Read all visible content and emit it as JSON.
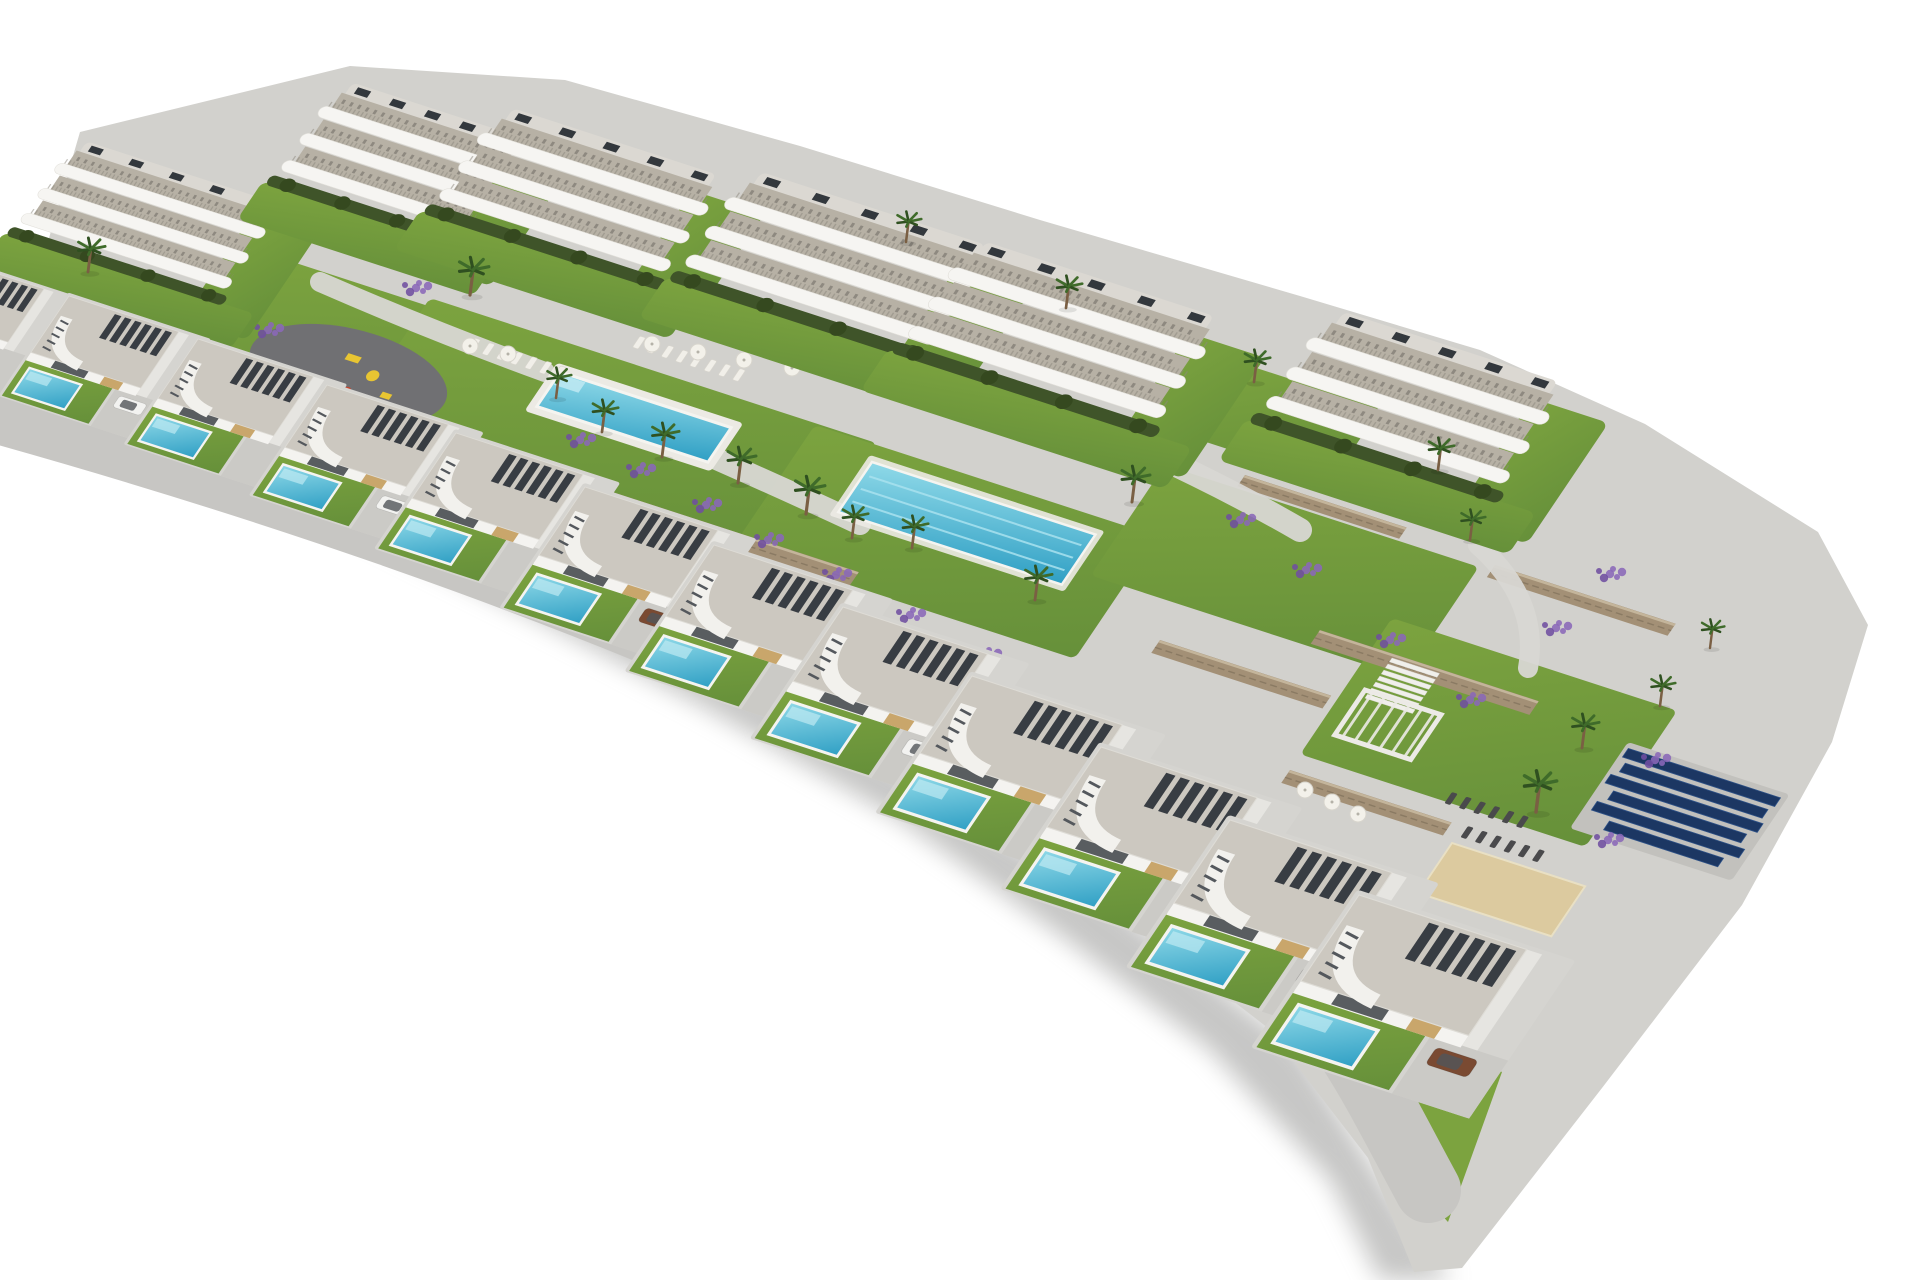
{
  "meta": {
    "type": "aerial-architectural-render",
    "description": "Aerial 3D render of a hillside residential development: six white curved-balcony apartment blocks along the top; landscaped gardens with a rectangular communal pool surrounded by sun loungers and parasols, a long lap pool, and a playground; stone retaining walls, palm trees and lavender beds; a stepped diagonal row of twelve modern villas, each with a gravel roof, dark pergola slats, curved stair canopy, lawn, private plunge pool and driveway; a solar-panel array, white pergola, dark loungers and a sand petanque court at the lower right; white background with soft drop shadow."
  },
  "summary": {
    "apartment_buildings": 6,
    "villas": 12,
    "private_pools": 12,
    "communal_pools": 2,
    "playgrounds": 1,
    "solar_panel_rows": 6,
    "visible_cars": 6,
    "palm_trees": 20
  },
  "colors": {
    "page_bg": "#ffffff",
    "ground": "#d2d1cd",
    "road": "#c7c6c3",
    "walkway": "#cfcecb",
    "path": "#d8d7d3",
    "concrete": "#d5d4d0",
    "driveway": "#cbcac6",
    "lawn": "#7ca33f",
    "lawn_dark": "#66903a",
    "hedge": "#3f5429",
    "hedge_dark": "#35491f",
    "pool_light": "#8fd9e8",
    "pool_deep": "#2f9fc4",
    "pool_step": "#bfe9f2",
    "pool_edge": "#f5f4f0",
    "lane_line": "#a9e2ef",
    "roof_gravel": "#ccc8c0",
    "roof_edge": "#dedcd6",
    "slat_dark": "#383d43",
    "wall_white": "#f4f3f0",
    "side_wall": "#e6e5e1",
    "wood": "#c9a66b",
    "window_dark": "#3d4247",
    "stone": "#a39076",
    "stone_line": "#8a7a63",
    "stone_top": "#c4b59b",
    "lavender": "#8a68b8",
    "lavender_dark": "#6f4fa0",
    "palm_frond": "#3f6b2a",
    "palm_frond_dark": "#2f5020",
    "palm_trunk": "#7a5f43",
    "solar": "#1c3763",
    "solar_stroke": "#2e5288",
    "solar_ground": "#c2c1bd",
    "floor_terrace": "#b7b1a5",
    "band_white": "#f6f5f2",
    "band_stroke": "#e2e0da",
    "rooftop": "#dbd8d2",
    "unit_dark": "#33383d",
    "deck": "#eceae4",
    "sand": "#d8c49a",
    "court": "#dcca9f",
    "court_edge": "#e9e0c4",
    "play_surface": "#707073",
    "play_yellow": "#e8c532",
    "play_red": "#c4452e",
    "lounger_light": "#f1efe9",
    "lounger_dark": "#4a4a4c",
    "parasol": "#f3f1ea",
    "parasol_edge": "#d8d5cd",
    "shadow": "#8e8e8c",
    "cars": {
      "white": "#f2f2f0",
      "brown": "#7a4a32",
      "gray": "#9a9a9a"
    }
  },
  "site": {
    "outline": "80,132 350,66 565,80 800,146 1040,220 1300,296 1480,350 1645,424 1818,532 1868,625 1832,742 1742,905 1602,1088 1462,1268 1414,1272 1368,1158 1268,1028 1118,912 958,803 788,698 618,596 452,510 298,446 148,400 18,372 0,366 0,330 42,262",
    "shadow": "0,388 160,418 420,520 640,630 880,760 1120,910 1300,1050 1420,1240 1452,1280 1380,1280 1330,1180 1210,1050 1060,935 900,820 700,705 520,610 340,520 150,448 0,410",
    "tail_lawn": "1398,1022 1502,1072 1448,1222 1408,1178"
  },
  "roads": [
    {
      "d": "M -70 392 C 300 492 640 612 980 780 S 1330 1010 1428 1190",
      "width": 66
    },
    {
      "d": "M -60 332 C 300 424 700 564 1050 742 S 1300 902 1392 982",
      "width": 24
    }
  ],
  "paths": [
    {
      "d": "M 320 282 Q 430 330 545 372",
      "width": 20
    },
    {
      "d": "M 655 432 Q 770 482 860 524",
      "width": 22
    },
    {
      "d": "M 1095 428 Q 1210 478 1300 530",
      "width": 24
    },
    {
      "d": "M 1478 545 Q 1540 600 1528 668",
      "width": 20
    }
  ],
  "lawns": [
    {
      "x": 262,
      "y": 252,
      "w": 380,
      "h": 118
    },
    {
      "x": 430,
      "y": 298,
      "w": 470,
      "h": 150
    },
    {
      "x": 815,
      "y": 425,
      "w": 360,
      "h": 142
    },
    {
      "x": 1165,
      "y": 465,
      "w": 330,
      "h": 128
    },
    {
      "x": 1238,
      "y": 362,
      "w": 150,
      "h": 86
    },
    {
      "x": 1392,
      "y": 618,
      "w": 300,
      "h": 158
    }
  ],
  "walls": [
    {
      "x": 255,
      "y": 392,
      "len": 300,
      "th": 15
    },
    {
      "x": 398,
      "y": 428,
      "len": 270,
      "th": 16
    },
    {
      "x": 470,
      "y": 462,
      "len": 120,
      "th": 14
    },
    {
      "x": 545,
      "y": 470,
      "len": 330,
      "th": 17
    },
    {
      "x": 690,
      "y": 590,
      "len": 470,
      "th": 17
    },
    {
      "x": 1160,
      "y": 640,
      "len": 180,
      "th": 15
    },
    {
      "x": 1245,
      "y": 475,
      "len": 170,
      "th": 13
    },
    {
      "x": 1320,
      "y": 630,
      "len": 230,
      "th": 16
    },
    {
      "x": 1290,
      "y": 770,
      "len": 170,
      "th": 15
    },
    {
      "x": 1495,
      "y": 565,
      "len": 190,
      "th": 14
    }
  ],
  "pools": {
    "main": {
      "x": 560,
      "y": 372,
      "w": 180,
      "h": 40
    },
    "lap": {
      "x": 872,
      "y": 462,
      "w": 235,
      "h": 58,
      "lanes": 3
    }
  },
  "playground": {
    "x": 305,
    "y": 318
  },
  "solar_array": {
    "x": 1628,
    "y": 742,
    "ground_w": 170,
    "ground_h": 100,
    "rows": [
      [
        4,
        160
      ],
      [
        10,
        150
      ],
      [
        4,
        160
      ],
      [
        16,
        140
      ],
      [
        8,
        155
      ],
      [
        30,
        120
      ]
    ]
  },
  "terrace": {
    "stairs": {
      "x": 1392,
      "y": 658,
      "steps": 7,
      "w": 50
    },
    "pergola": {
      "x": 1365,
      "y": 690,
      "w": 80,
      "h": 52,
      "slats": 6
    },
    "court": {
      "x": 1452,
      "y": 843,
      "w": 140,
      "h": 58
    }
  },
  "loungers": [
    {
      "x": 475,
      "y": 338,
      "n": 7,
      "dark": false
    },
    {
      "x": 640,
      "y": 336,
      "n": 8,
      "dark": false
    },
    {
      "x": 1005,
      "y": 415,
      "n": 5,
      "dark": false
    },
    {
      "x": 1452,
      "y": 792,
      "n": 6,
      "dark": true
    },
    {
      "x": 1468,
      "y": 826,
      "n": 6,
      "dark": true
    }
  ],
  "parasols": [
    [
      470,
      346
    ],
    [
      508,
      354
    ],
    [
      652,
      344
    ],
    [
      698,
      352
    ],
    [
      744,
      360
    ],
    [
      792,
      368
    ],
    [
      1305,
      790
    ],
    [
      1332,
      802
    ],
    [
      1358,
      814
    ]
  ],
  "lavender": [
    [
      300,
      208
    ],
    [
      352,
      236
    ],
    [
      416,
      288
    ],
    [
      268,
      330
    ],
    [
      580,
      440
    ],
    [
      640,
      470
    ],
    [
      706,
      505
    ],
    [
      768,
      540
    ],
    [
      836,
      575
    ],
    [
      910,
      615
    ],
    [
      986,
      655
    ],
    [
      1240,
      520
    ],
    [
      1306,
      570
    ],
    [
      1390,
      640
    ],
    [
      1470,
      700
    ],
    [
      1556,
      628
    ],
    [
      1610,
      574
    ],
    [
      1655,
      760
    ],
    [
      1608,
      840
    ]
  ],
  "palms": [
    [
      88,
      272,
      0.95
    ],
    [
      470,
      295,
      1.05
    ],
    [
      602,
      432,
      0.9
    ],
    [
      662,
      457,
      0.95
    ],
    [
      738,
      483,
      1.0
    ],
    [
      806,
      514,
      1.05
    ],
    [
      852,
      538,
      0.9
    ],
    [
      906,
      242,
      0.85
    ],
    [
      1066,
      308,
      0.9
    ],
    [
      1254,
      382,
      0.9
    ],
    [
      1438,
      470,
      0.9
    ],
    [
      1132,
      502,
      1.0
    ],
    [
      1536,
      812,
      1.15
    ],
    [
      1582,
      748,
      0.95
    ],
    [
      1660,
      706,
      0.85
    ],
    [
      1710,
      648,
      0.8
    ],
    [
      912,
      548,
      0.9
    ],
    [
      1035,
      600,
      0.95
    ],
    [
      556,
      398,
      0.85
    ],
    [
      1470,
      540,
      0.85
    ]
  ],
  "apartment_buildings": [
    {
      "x": 75,
      "y": 150,
      "s": 0.85,
      "w": 240
    },
    {
      "x": 340,
      "y": 92,
      "s": 0.92,
      "w": 200
    },
    {
      "x": 500,
      "y": 118,
      "s": 0.95,
      "w": 235
    },
    {
      "x": 748,
      "y": 182,
      "s": 0.98,
      "w": 250
    },
    {
      "x": 972,
      "y": 252,
      "s": 1.0,
      "w": 250
    },
    {
      "x": 1330,
      "y": 322,
      "s": 1.0,
      "w": 235
    }
  ],
  "villas": [
    {
      "x": -60,
      "y": 255,
      "s": 0.72,
      "car": null
    },
    {
      "x": 69,
      "y": 296,
      "s": 0.76,
      "car": "white"
    },
    {
      "x": 198,
      "y": 339,
      "s": 0.8,
      "car": null
    },
    {
      "x": 327,
      "y": 385,
      "s": 0.84,
      "car": "white"
    },
    {
      "x": 456,
      "y": 433,
      "s": 0.88,
      "car": null
    },
    {
      "x": 585,
      "y": 487,
      "s": 0.92,
      "car": "brown"
    },
    {
      "x": 714,
      "y": 545,
      "s": 0.96,
      "car": null
    },
    {
      "x": 843,
      "y": 607,
      "s": 1.0,
      "car": "white"
    },
    {
      "x": 972,
      "y": 676,
      "s": 1.04,
      "car": null
    },
    {
      "x": 1101,
      "y": 747,
      "s": 1.08,
      "car": null
    },
    {
      "x": 1230,
      "y": 820,
      "s": 1.12,
      "car": "gray"
    },
    {
      "x": 1359,
      "y": 895,
      "s": 1.16,
      "car": "brown"
    }
  ]
}
